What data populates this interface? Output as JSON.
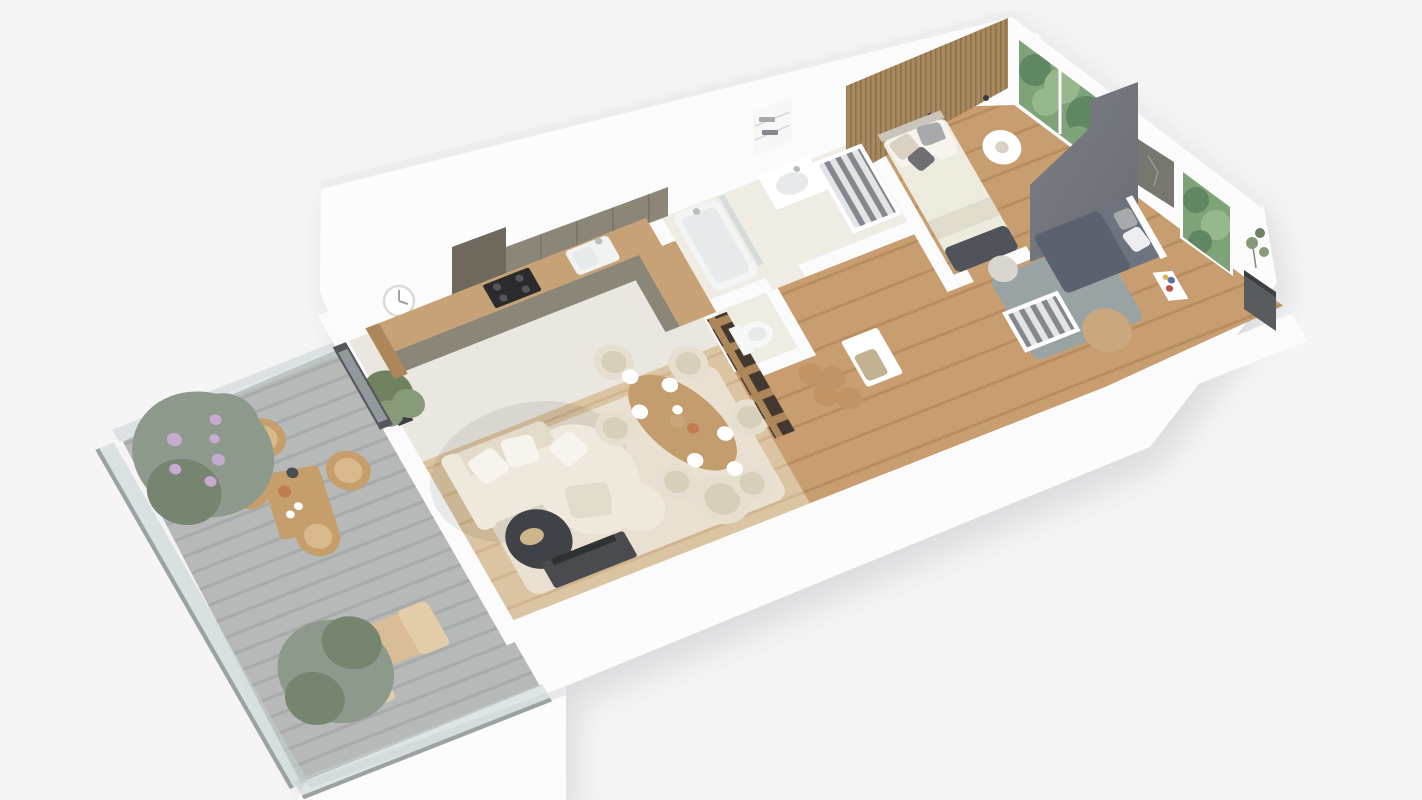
{
  "scene": {
    "kind": "isometric-apartment-floorplan-render",
    "rooms": [
      {
        "name": "balcony",
        "furniture": [
          "outdoor-dining-set",
          "two-sun-loungers",
          "flowering-bush",
          "gray-green-bush",
          "glass-railing",
          "slatted-deck"
        ]
      },
      {
        "name": "living-room",
        "furniture": [
          "sectional-sofa",
          "round-marble-coffee-table",
          "tv-console",
          "cream-pouf",
          "armchair",
          "cream-rug",
          "wall-clock",
          "potted-plant",
          "balcony-door"
        ]
      },
      {
        "name": "kitchen",
        "furniture": [
          "l-shaped-counter",
          "upper-cabinets",
          "induction-hob",
          "sink-with-faucet"
        ]
      },
      {
        "name": "dining-area",
        "furniture": [
          "oval-wood-table",
          "six-upholstered-chairs",
          "place-settings",
          "dried-grass-centerpiece"
        ]
      },
      {
        "name": "hallway",
        "furniture": [
          "display-shelf-with-bottles",
          "storage-bench",
          "cork-stools",
          "checkered-cushion"
        ]
      },
      {
        "name": "wc",
        "furniture": [
          "toilet"
        ]
      },
      {
        "name": "bathroom",
        "furniture": [
          "bathtub",
          "shower-glass",
          "vanity-with-sink",
          "laundry-shelves",
          "wardrobe-with-clothes"
        ]
      },
      {
        "name": "main-bedroom",
        "furniture": [
          "double-bed",
          "pillows",
          "dark-throw",
          "round-side-table",
          "wood-slat-accent-wall",
          "wall-sconces",
          "window-greenery"
        ]
      },
      {
        "name": "second-bedroom",
        "furniture": [
          "single-bed",
          "dark-divider-wall",
          "open-wardrobe",
          "gray-rug",
          "jute-pouf",
          "kids-easel",
          "artwork",
          "window-greenery",
          "outdoor-planter-box"
        ]
      }
    ]
  },
  "colors": {
    "bg": "#f5f5f6",
    "shell": "#fcfcfd",
    "wallWhite": "#fbfbfc",
    "wallTopShade": "#ededef",
    "plinthShade": "#e9e9ec",
    "tile": "#eae7e1",
    "bathTile": "#efece4",
    "woodLight": "#dbc4a2",
    "woodLightLine": "#cfb48e",
    "oak": "#c89e71",
    "oakLine": "#b78d60",
    "rugCream": "#e9e0d2",
    "rugGray": "#9aa3a3",
    "deck": "#b6b9b7",
    "deckLine": "#a6aaa8",
    "glass": "#c3d0d2",
    "railLine": "#9ba2a2",
    "sofa": "#efe9dd",
    "sofaShade": "#e3dbca",
    "pillowWhite": "#f7f4ee",
    "marble": "#3f4246",
    "gold": "#ccb68c",
    "tv": "#494b4e",
    "tvScreen": "#2f3133",
    "counterWood": "#c8a277",
    "cabinet": "#8c8678",
    "cabinetDark": "#6e695c",
    "hob": "#2b2b2d",
    "hobRing": "#55555a",
    "sinkWhite": "#f1f3f2",
    "steel": "#b9bdc0",
    "slat": "#a8895f",
    "slatLine": "#8c7049",
    "dividerLight": "#7b7d85",
    "dividerDark": "#6b6d75",
    "foliageBase": "#7fa379",
    "foliageDark": "#5f8763",
    "foliageLight": "#97b78c",
    "bushGray": "#8d9a8b",
    "bushShade": "#76856f",
    "flowerPurple": "#c6aacf",
    "outdoorWood": "#c59e6c",
    "outdoorSeat": "#d8b98c",
    "lounger": "#d8bd96",
    "loungerBack": "#e3cda8",
    "bedCream": "#edeade",
    "bedFold": "#e0dccc",
    "bedThrow": "#50545a",
    "pillowBeige": "#d9d2c2",
    "pillowDark": "#6d6f72",
    "pillowPattern": "#a8a9ab",
    "headboard": "#c9c5bd",
    "bed2": "#6e7380",
    "bed2Duvet": "#5c6170",
    "bed2Pillow": "#eceef0",
    "clothesLight": "#e3e4e6",
    "clothesDark": "#84878d",
    "shelfWood": "#ad8659",
    "cubbyDark": "#42382f",
    "art": "#77776f",
    "artLight": "#8b8b89",
    "planter": "#595c5e",
    "planterTop": "#3e4143",
    "jute": "#c8a87c",
    "toiletWhite": "#f6f7f7",
    "tub": "#f3f4f4",
    "tubInner": "#e7eaea",
    "clockFace": "#ffffff",
    "clockRim": "#d9dadb",
    "clockHand": "#9fa3a6",
    "doorDark": "#55575c",
    "potDark": "#3e3f41",
    "plantGreen": "#6f815f",
    "plantLight": "#879a7a",
    "checker": "#c2b292",
    "cork": "#c29465",
    "chair": "#e6dfcf",
    "chairShade": "#d7cfba",
    "tableWood": "#c49d6e",
    "plate": "#ffffff",
    "grassDry": "#c9a77a",
    "vaseDark": "#4a4e52",
    "bowlTerracotta": "#c27c4f",
    "white": "#ffffff",
    "poufGray": "#d9d6d0"
  }
}
